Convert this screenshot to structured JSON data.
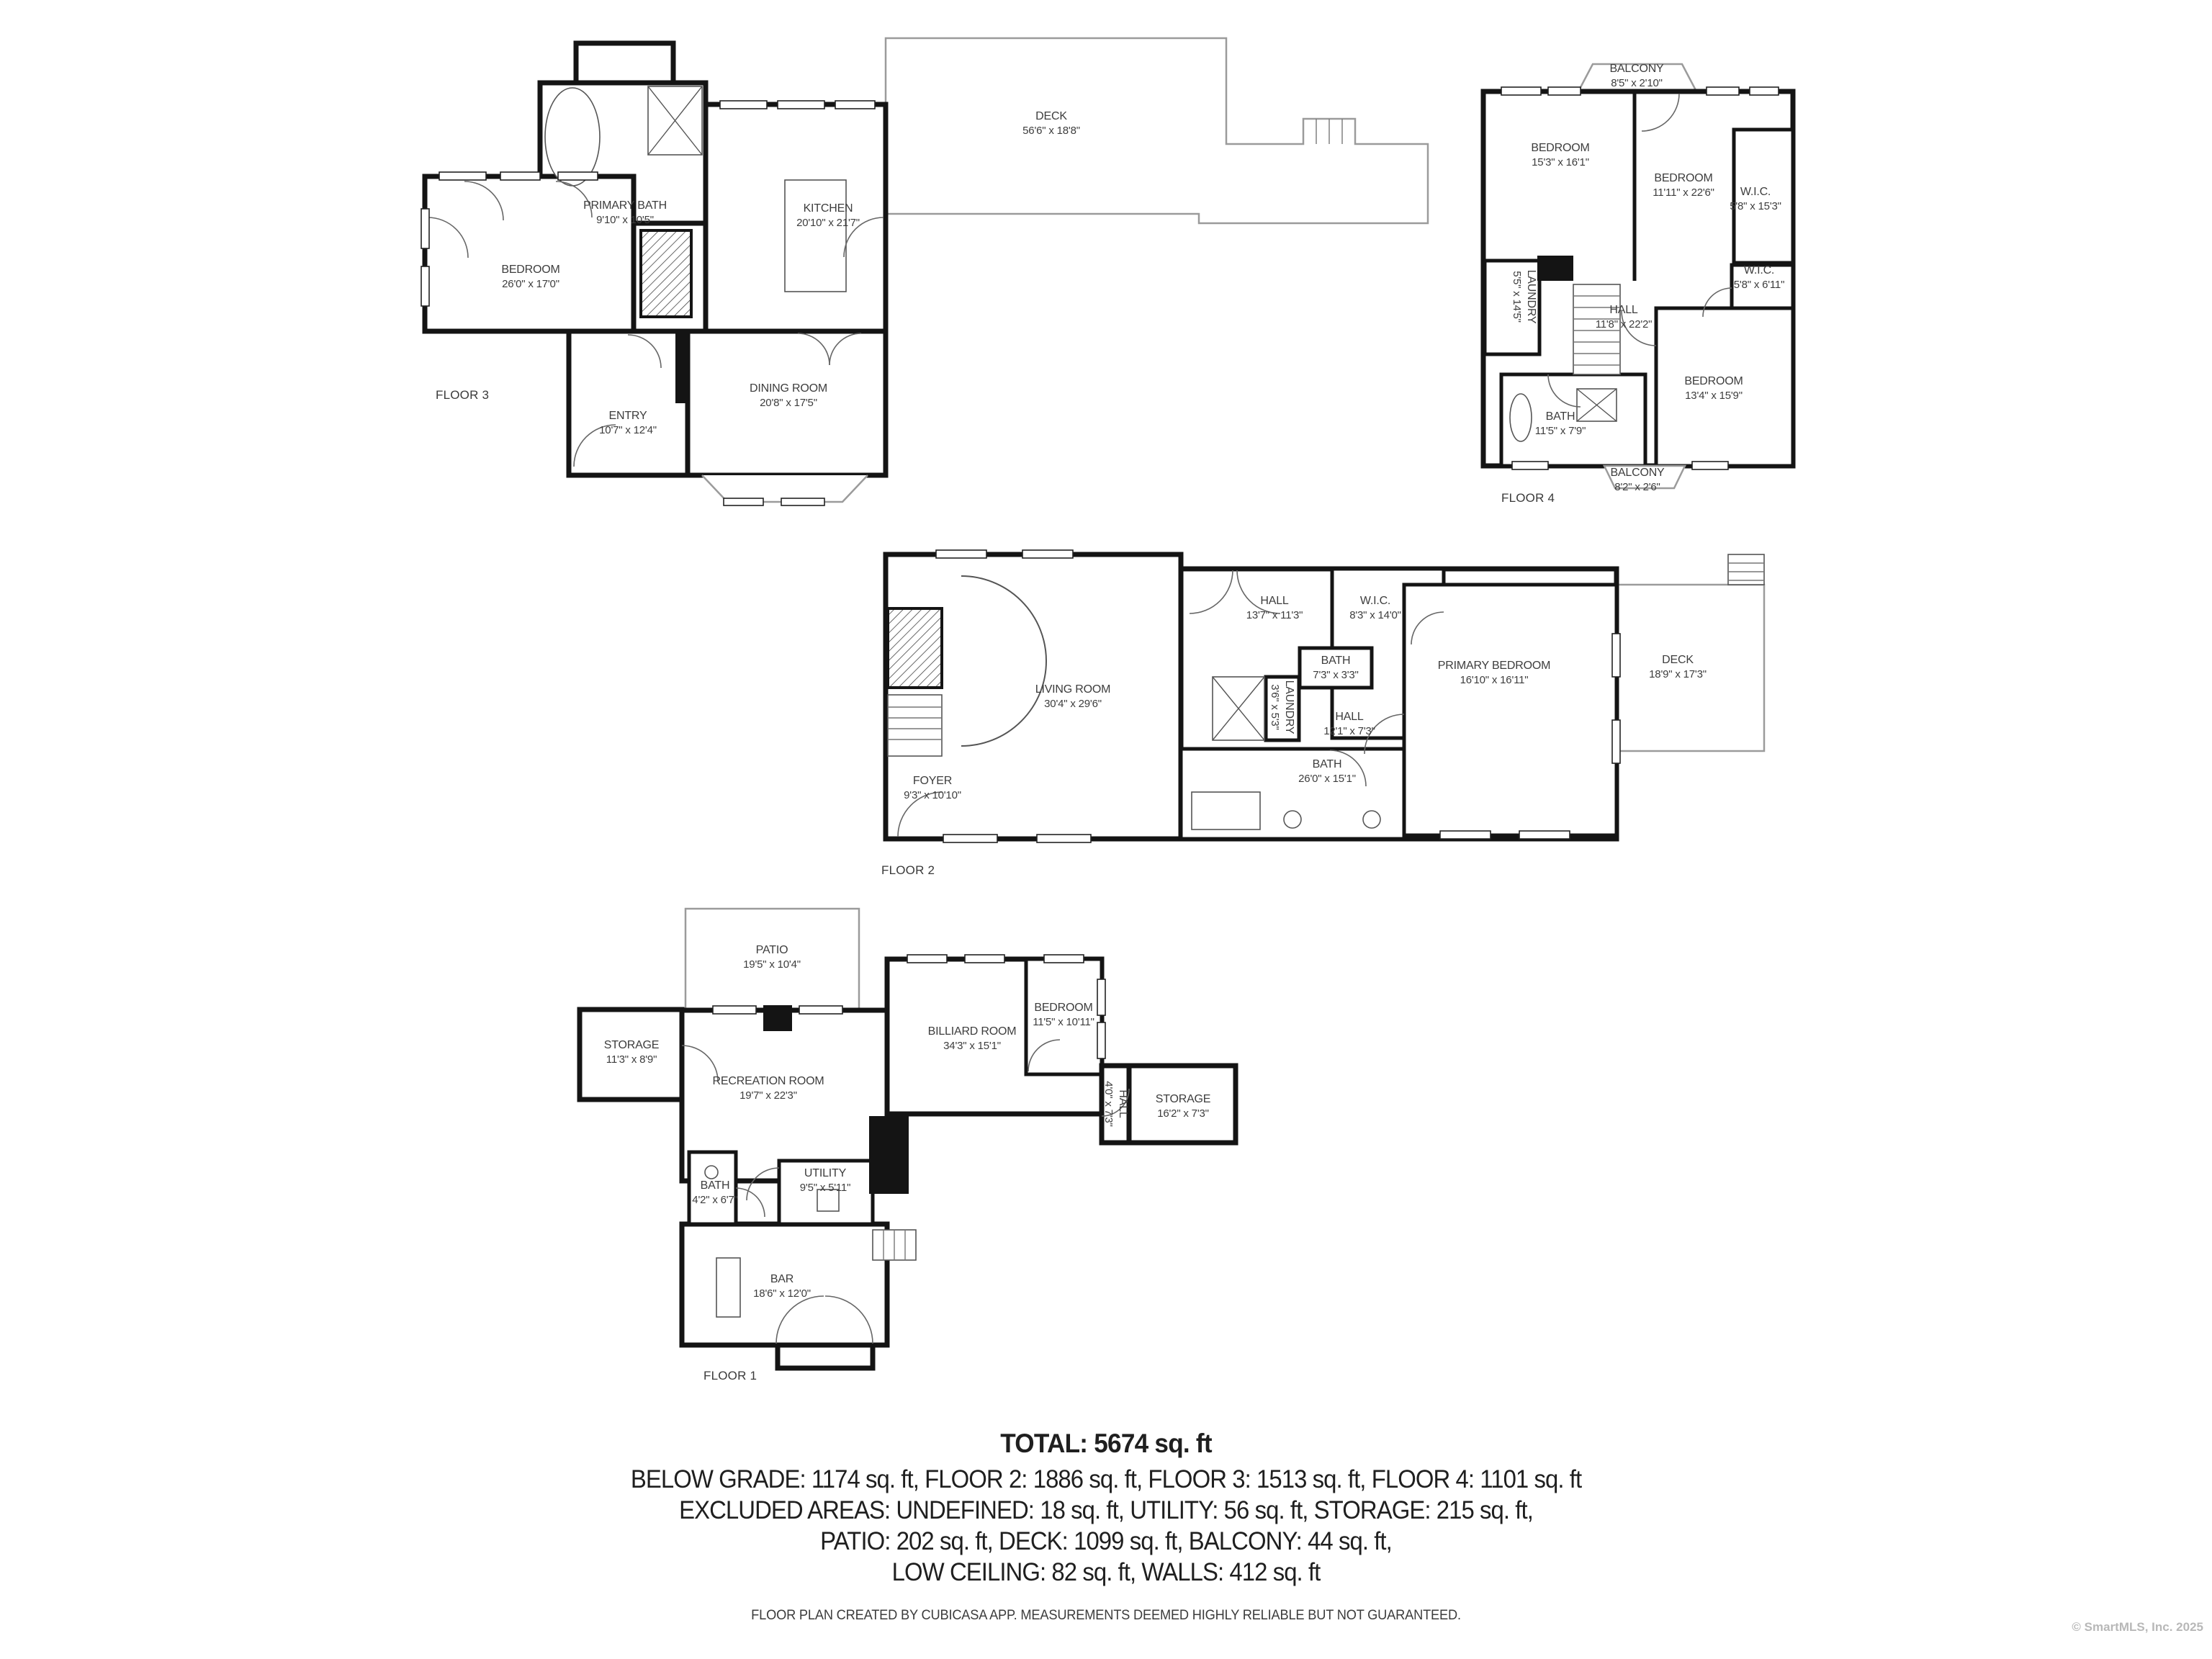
{
  "branding": {
    "disclaimer": "FLOOR PLAN CREATED BY CUBICASA APP. MEASUREMENTS DEEMED HIGHLY RELIABLE BUT NOT GUARANTEED.",
    "copyright": "© SmartMLS, Inc. 2025"
  },
  "summary": {
    "total": "TOTAL: 5674 sq. ft",
    "lines": [
      "BELOW GRADE: 1174 sq. ft, FLOOR 2: 1886 sq. ft, FLOOR 3: 1513 sq. ft, FLOOR 4: 1101 sq. ft",
      "EXCLUDED AREAS: UNDEFINED: 18 sq. ft, UTILITY: 56 sq. ft, STORAGE: 215 sq. ft,",
      "PATIO: 202 sq. ft, DECK: 1099 sq. ft, BALCONY: 44 sq. ft,",
      "LOW CEILING: 82 sq. ft, WALLS: 412 sq. ft"
    ]
  },
  "floors": [
    {
      "label": "FLOOR 3",
      "rooms": [
        {
          "name": "PRIMARY BATH",
          "dims": "9'10\" x 10'5\""
        },
        {
          "name": "BEDROOM",
          "dims": "26'0\" x 17'0\""
        },
        {
          "name": "KITCHEN",
          "dims": "20'10\" x 21'7\""
        },
        {
          "name": "DECK",
          "dims": "56'6\" x 18'8\""
        },
        {
          "name": "DINING ROOM",
          "dims": "20'8\" x 17'5\""
        },
        {
          "name": "ENTRY",
          "dims": "10'7\" x 12'4\""
        }
      ]
    },
    {
      "label": "FLOOR 4",
      "rooms": [
        {
          "name": "BALCONY",
          "dims": "8'5\" x 2'10\""
        },
        {
          "name": "BEDROOM",
          "dims": "15'3\" x 16'1\""
        },
        {
          "name": "BEDROOM",
          "dims": "11'11\" x 22'6\""
        },
        {
          "name": "W.I.C.",
          "dims": "5'8\" x 15'3\""
        },
        {
          "name": "W.I.C.",
          "dims": "5'8\" x 6'11\""
        },
        {
          "name": "LAUNDRY",
          "dims": "5'5\" x 14'5\""
        },
        {
          "name": "HALL",
          "dims": "11'8\" x 22'2\""
        },
        {
          "name": "BEDROOM",
          "dims": "13'4\" x 15'9\""
        },
        {
          "name": "BATH",
          "dims": "11'5\" x 7'9\""
        },
        {
          "name": "BALCONY",
          "dims": "8'2\" x 2'6\""
        }
      ]
    },
    {
      "label": "FLOOR 2",
      "rooms": [
        {
          "name": "LIVING ROOM",
          "dims": "30'4\" x 29'6\""
        },
        {
          "name": "FOYER",
          "dims": "9'3\" x 10'10\""
        },
        {
          "name": "HALL",
          "dims": "13'7\" x 11'3\""
        },
        {
          "name": "W.I.C.",
          "dims": "8'3\" x 14'0\""
        },
        {
          "name": "BATH",
          "dims": "7'3\" x 3'3\""
        },
        {
          "name": "LAUNDRY",
          "dims": "3'6\" x 5'3\""
        },
        {
          "name": "HALL",
          "dims": "12'1\" x 7'3\""
        },
        {
          "name": "BATH",
          "dims": "26'0\" x 15'1\""
        },
        {
          "name": "PRIMARY BEDROOM",
          "dims": "16'10\" x 16'11\""
        },
        {
          "name": "DECK",
          "dims": "18'9\" x 17'3\""
        }
      ]
    },
    {
      "label": "FLOOR 1",
      "rooms": [
        {
          "name": "PATIO",
          "dims": "19'5\" x 10'4\""
        },
        {
          "name": "STORAGE",
          "dims": "11'3\" x 8'9\""
        },
        {
          "name": "RECREATION ROOM",
          "dims": "19'7\" x 22'3\""
        },
        {
          "name": "BILLIARD ROOM",
          "dims": "34'3\" x 15'1\""
        },
        {
          "name": "BEDROOM",
          "dims": "11'5\" x 10'11\""
        },
        {
          "name": "HALL",
          "dims": "4'0\" x 7'3\""
        },
        {
          "name": "STORAGE",
          "dims": "16'2\" x 7'3\""
        },
        {
          "name": "BATH",
          "dims": "4'2\" x 6'7\""
        },
        {
          "name": "UTILITY",
          "dims": "9'5\" x 5'11\""
        },
        {
          "name": "BAR",
          "dims": "18'6\" x 12'0\""
        }
      ]
    }
  ]
}
